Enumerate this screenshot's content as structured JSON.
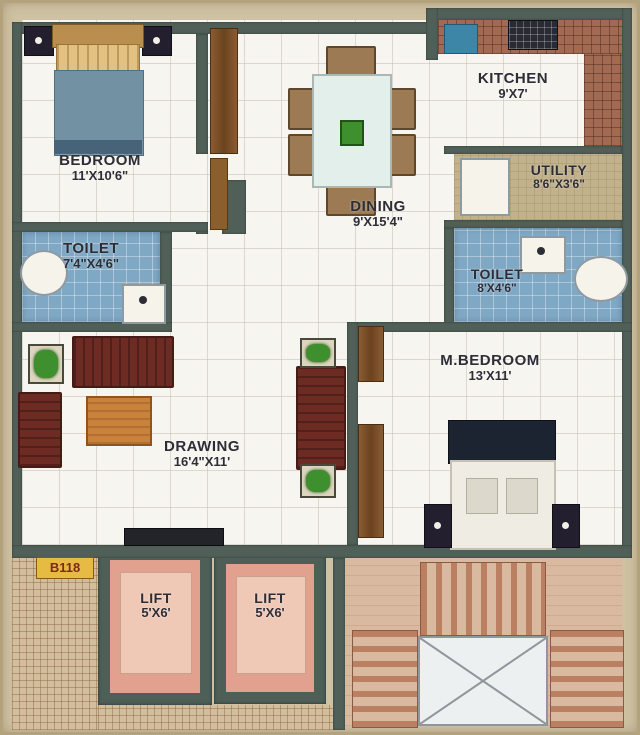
{
  "unit": {
    "label": "B118"
  },
  "rooms": {
    "bedroom": {
      "name": "BEDROOM",
      "dims": "11'X10'6\""
    },
    "toilet1": {
      "name": "TOILET",
      "dims": "7'4\"X4'6\""
    },
    "dining": {
      "name": "DINING",
      "dims": "9'X15'4\""
    },
    "kitchen": {
      "name": "KITCHEN",
      "dims": "9'X7'"
    },
    "utility": {
      "name": "UTILITY",
      "dims": "8'6\"X3'6\""
    },
    "toilet2": {
      "name": "TOILET",
      "dims": "8'X4'6\""
    },
    "mbedroom": {
      "name": "M.BEDROOM",
      "dims": "13'X11'"
    },
    "drawing": {
      "name": "DRAWING",
      "dims": "16'4\"X11'"
    },
    "lift1": {
      "name": "LIFT",
      "dims": "5'X6'"
    },
    "lift2": {
      "name": "LIFT",
      "dims": "5'X6'"
    }
  },
  "colors": {
    "wall": "#505f57",
    "background": "#cfc2a2",
    "floor": "#f7f5ef",
    "toilet_tile": "#7fa8c4",
    "utility_floor": "#c2b28c",
    "kitchen_counter": "#a26a52",
    "lift_cab": "#e2a18f",
    "stairs": "#d9b9a0",
    "sofa": "#6e2b24",
    "unit_chip": "#e7bb43"
  }
}
